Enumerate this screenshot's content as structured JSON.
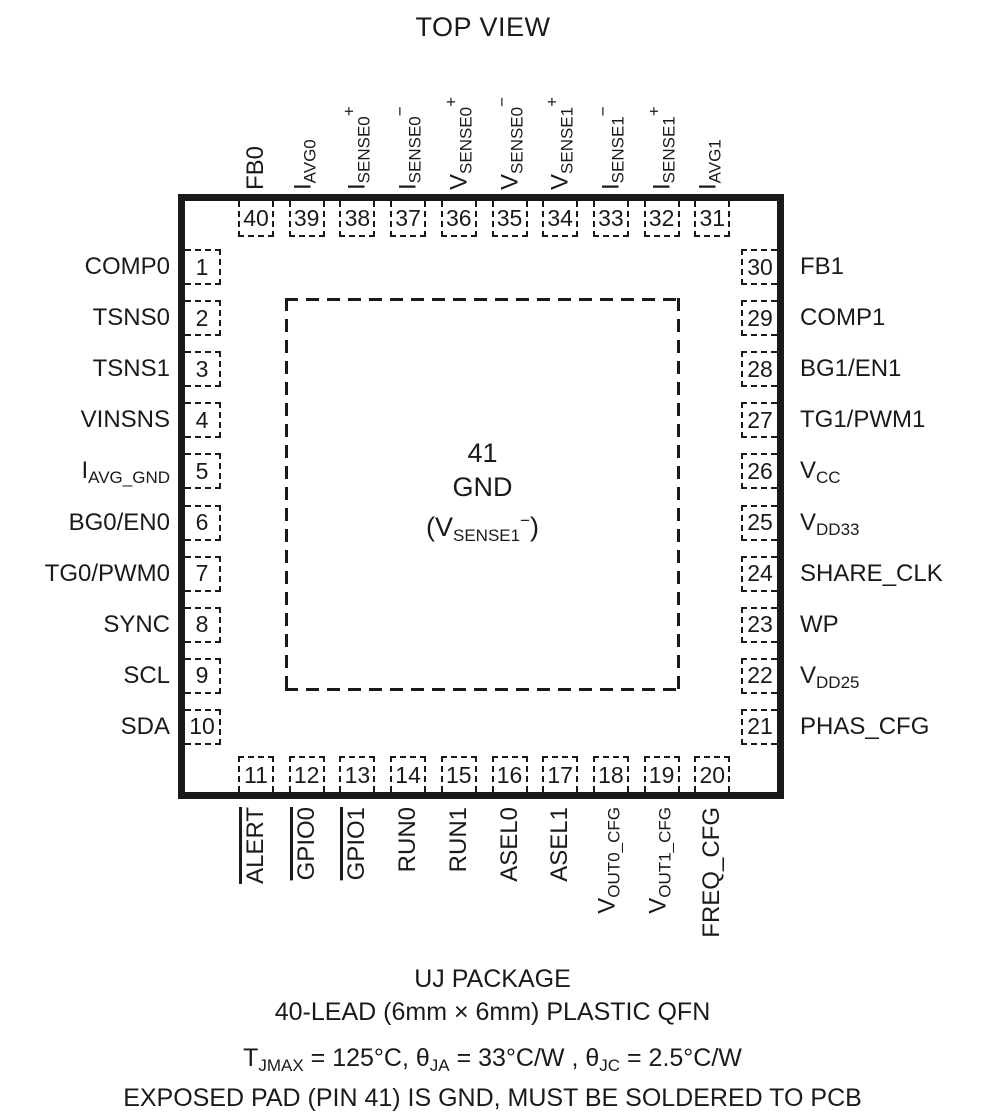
{
  "title": "TOP VIEW",
  "colors": {
    "ink": "#1a1a1a",
    "background": "#ffffff"
  },
  "pins": {
    "top": [
      {
        "num": "40",
        "parts": [
          {
            "t": "FB0"
          }
        ]
      },
      {
        "num": "39",
        "parts": [
          {
            "t": "I"
          },
          {
            "t": "AVG0",
            "s": "sub"
          }
        ]
      },
      {
        "num": "38",
        "parts": [
          {
            "t": "I"
          },
          {
            "t": "SENSE0",
            "s": "sub"
          },
          {
            "t": "+",
            "s": "sup"
          }
        ]
      },
      {
        "num": "37",
        "parts": [
          {
            "t": "I"
          },
          {
            "t": "SENSE0",
            "s": "sub"
          },
          {
            "t": "−",
            "s": "sup"
          }
        ]
      },
      {
        "num": "36",
        "parts": [
          {
            "t": "V"
          },
          {
            "t": "SENSE0",
            "s": "sub"
          },
          {
            "t": "+",
            "s": "sup"
          }
        ]
      },
      {
        "num": "35",
        "parts": [
          {
            "t": "V"
          },
          {
            "t": "SENSE0",
            "s": "sub"
          },
          {
            "t": "−",
            "s": "sup"
          }
        ]
      },
      {
        "num": "34",
        "parts": [
          {
            "t": "V"
          },
          {
            "t": "SENSE1",
            "s": "sub"
          },
          {
            "t": "+",
            "s": "sup"
          }
        ]
      },
      {
        "num": "33",
        "parts": [
          {
            "t": "I"
          },
          {
            "t": "SENSE1",
            "s": "sub"
          },
          {
            "t": "−",
            "s": "sup"
          }
        ]
      },
      {
        "num": "32",
        "parts": [
          {
            "t": "I"
          },
          {
            "t": "SENSE1",
            "s": "sub"
          },
          {
            "t": "+",
            "s": "sup"
          }
        ]
      },
      {
        "num": "31",
        "parts": [
          {
            "t": "I"
          },
          {
            "t": "AVG1",
            "s": "sub"
          }
        ]
      }
    ],
    "left": [
      {
        "num": "1",
        "parts": [
          {
            "t": "COMP0"
          }
        ]
      },
      {
        "num": "2",
        "parts": [
          {
            "t": "TSNS0"
          }
        ]
      },
      {
        "num": "3",
        "parts": [
          {
            "t": "TSNS1"
          }
        ]
      },
      {
        "num": "4",
        "parts": [
          {
            "t": "VINSNS"
          }
        ]
      },
      {
        "num": "5",
        "parts": [
          {
            "t": "I"
          },
          {
            "t": "AVG_GND",
            "s": "sub"
          }
        ]
      },
      {
        "num": "6",
        "parts": [
          {
            "t": "BG0/EN0"
          }
        ]
      },
      {
        "num": "7",
        "parts": [
          {
            "t": "TG0/PWM0"
          }
        ]
      },
      {
        "num": "8",
        "parts": [
          {
            "t": "SYNC"
          }
        ]
      },
      {
        "num": "9",
        "parts": [
          {
            "t": "SCL"
          }
        ]
      },
      {
        "num": "10",
        "parts": [
          {
            "t": "SDA"
          }
        ]
      }
    ],
    "right": [
      {
        "num": "30",
        "parts": [
          {
            "t": "FB1"
          }
        ]
      },
      {
        "num": "29",
        "parts": [
          {
            "t": "COMP1"
          }
        ]
      },
      {
        "num": "28",
        "parts": [
          {
            "t": "BG1/EN1"
          }
        ]
      },
      {
        "num": "27",
        "parts": [
          {
            "t": "TG1/PWM1"
          }
        ]
      },
      {
        "num": "26",
        "parts": [
          {
            "t": "V"
          },
          {
            "t": "CC",
            "s": "sub"
          }
        ]
      },
      {
        "num": "25",
        "parts": [
          {
            "t": "V"
          },
          {
            "t": "DD33",
            "s": "sub"
          }
        ]
      },
      {
        "num": "24",
        "parts": [
          {
            "t": "SHARE_CLK"
          }
        ]
      },
      {
        "num": "23",
        "parts": [
          {
            "t": "WP"
          }
        ]
      },
      {
        "num": "22",
        "parts": [
          {
            "t": "V"
          },
          {
            "t": "DD25",
            "s": "sub"
          }
        ]
      },
      {
        "num": "21",
        "parts": [
          {
            "t": "PHAS_CFG"
          }
        ]
      }
    ],
    "bottom": [
      {
        "num": "11",
        "overline": true,
        "parts": [
          {
            "t": "ALERT"
          }
        ]
      },
      {
        "num": "12",
        "overline": true,
        "parts": [
          {
            "t": "GPIO0"
          }
        ]
      },
      {
        "num": "13",
        "overline": true,
        "parts": [
          {
            "t": "GPIO1"
          }
        ]
      },
      {
        "num": "14",
        "parts": [
          {
            "t": "RUN0"
          }
        ]
      },
      {
        "num": "15",
        "parts": [
          {
            "t": "RUN1"
          }
        ]
      },
      {
        "num": "16",
        "parts": [
          {
            "t": "ASEL0"
          }
        ]
      },
      {
        "num": "17",
        "parts": [
          {
            "t": "ASEL1"
          }
        ]
      },
      {
        "num": "18",
        "parts": [
          {
            "t": "V"
          },
          {
            "t": "OUT0_CFG",
            "s": "sub"
          }
        ]
      },
      {
        "num": "19",
        "parts": [
          {
            "t": "V"
          },
          {
            "t": "OUT1_CFG",
            "s": "sub"
          }
        ]
      },
      {
        "num": "20",
        "parts": [
          {
            "t": "FREQ_CFG"
          }
        ]
      }
    ]
  },
  "center_pad": {
    "pin_number": "41",
    "name": "GND",
    "alt_parts": [
      {
        "t": "(V"
      },
      {
        "t": "SENSE1",
        "s": "sub"
      },
      {
        "t": "−",
        "s": "sup"
      },
      {
        "t": ")"
      }
    ]
  },
  "footer": {
    "package_name": "UJ PACKAGE",
    "package_description": "40-LEAD (6mm × 6mm) PLASTIC QFN",
    "thermal_parts": [
      {
        "t": "T"
      },
      {
        "t": "JMAX",
        "s": "sub"
      },
      {
        "t": " = 125°C, θ"
      },
      {
        "t": "JA",
        "s": "sub"
      },
      {
        "t": " = 33°C/W , θ"
      },
      {
        "t": "JC",
        "s": "sub"
      },
      {
        "t": " = 2.5°C/W"
      }
    ],
    "exposed_pad_note": "EXPOSED PAD (PIN 41) IS GND, MUST BE SOLDERED TO PCB"
  }
}
